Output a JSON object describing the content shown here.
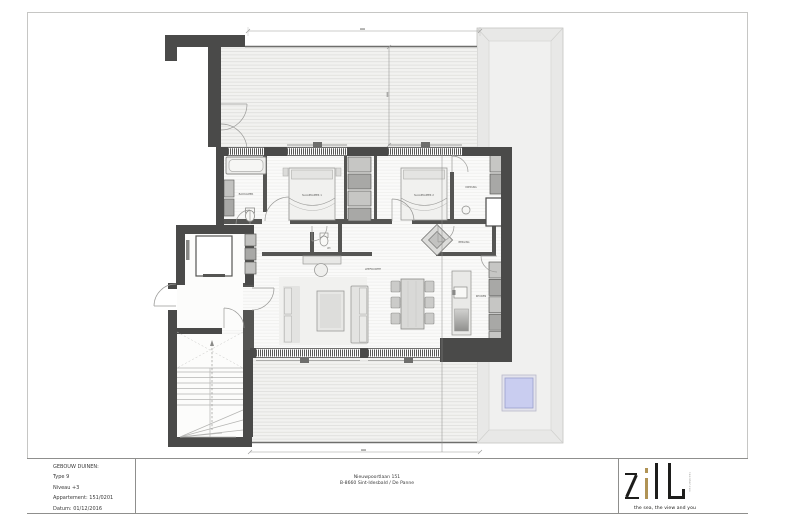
{
  "doc": {
    "title_block": {
      "project": "GEBOUW DUINEN:",
      "type": "Type 9",
      "level": "Niveau +3",
      "apartment": "Appartement: 151/0201",
      "date": "Datum: 01/12/2016"
    },
    "address": {
      "line1": "Nieuwpoortlaan 151",
      "line2": "B-8660 Sint-Idesbald / De Panne"
    },
    "logo": {
      "name": "zilt",
      "sub": "residences",
      "tagline": "the sea, the view and you"
    }
  },
  "plan": {
    "rooms": {
      "bathroom": "BADKAMER",
      "bedroom1": "SLAAPKAMER 1",
      "bedroom2": "SLAAPKAMER 2",
      "dressing": "DRESSING",
      "wc": "WC",
      "storage": "BERGING",
      "living": "LEEFRUIMTE",
      "kitchen": "KEUKEN"
    }
  },
  "colors": {
    "wall": "#4a4a49",
    "logo_gold": "#b09355",
    "skylight": "#c9cdf0"
  }
}
